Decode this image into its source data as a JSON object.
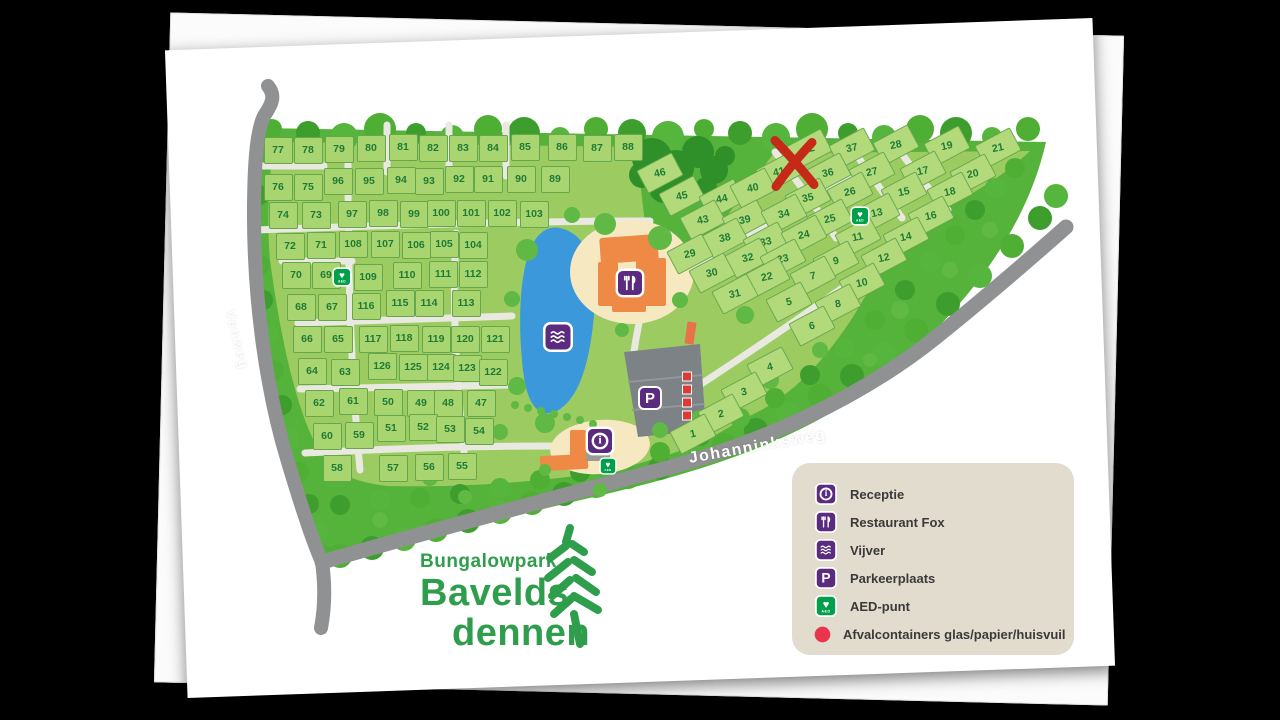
{
  "park_name": {
    "line1": "Bungalowpark",
    "line2": "Bavelds",
    "line3": "dennen"
  },
  "roads": {
    "venweg": {
      "text": "Venweg"
    },
    "johanninksweg": {
      "text": "Johanninksweg"
    }
  },
  "icons": {
    "receptie_glyph": "i",
    "parkeer_glyph": "P",
    "aed_text": "AED",
    "heart_glyph": "♥"
  },
  "legend": {
    "items": [
      {
        "icon": "receptie-icon",
        "label": "Receptie"
      },
      {
        "icon": "restaurant-icon",
        "label": "Restaurant Fox"
      },
      {
        "icon": "vijver-icon",
        "label": "Vijver"
      },
      {
        "icon": "parkeerplaats-icon",
        "label": "Parkeerplaats"
      },
      {
        "icon": "aed-icon",
        "label": "AED-punt"
      },
      {
        "icon": "afvalcontainer-icon",
        "label": "Afvalcontainers glas/papier/huisvuil"
      }
    ]
  },
  "colors": {
    "forest_green": "#55B23A",
    "interior_green": "#9CCB61",
    "plot_green": "#A9D571",
    "plot_number_green": "#1E7B36",
    "road_gray": "#8F9192",
    "path_white": "#E9E9E2",
    "pond_blue": "#3B99DB",
    "icon_purple": "#5B2B80",
    "aed_green": "#00A04B",
    "alert_red": "#DE3A34",
    "legend_bg": "#E2DCCF",
    "logo_green": "#2F9E4C",
    "building_orange": "#EE8A45",
    "sand_tan": "#F6E9C1"
  },
  "map": {
    "marker_x_note": "red X over plot 41",
    "plots": [
      {
        "n": "77",
        "x": 278,
        "y": 150,
        "s": "g"
      },
      {
        "n": "78",
        "x": 308,
        "y": 150,
        "s": "g"
      },
      {
        "n": "79",
        "x": 339,
        "y": 149,
        "s": "g"
      },
      {
        "n": "80",
        "x": 371,
        "y": 148,
        "s": "g"
      },
      {
        "n": "81",
        "x": 403,
        "y": 147,
        "s": "g"
      },
      {
        "n": "82",
        "x": 433,
        "y": 148,
        "s": "g"
      },
      {
        "n": "83",
        "x": 463,
        "y": 148,
        "s": "g"
      },
      {
        "n": "84",
        "x": 493,
        "y": 148,
        "s": "g"
      },
      {
        "n": "85",
        "x": 525,
        "y": 147,
        "s": "g"
      },
      {
        "n": "86",
        "x": 562,
        "y": 147,
        "s": "g"
      },
      {
        "n": "87",
        "x": 597,
        "y": 148,
        "s": "g"
      },
      {
        "n": "88",
        "x": 628,
        "y": 147,
        "s": "g"
      },
      {
        "n": "76",
        "x": 278,
        "y": 187,
        "s": "g"
      },
      {
        "n": "75",
        "x": 308,
        "y": 187,
        "s": "g"
      },
      {
        "n": "96",
        "x": 338,
        "y": 181,
        "s": "g"
      },
      {
        "n": "95",
        "x": 369,
        "y": 181,
        "s": "g"
      },
      {
        "n": "94",
        "x": 401,
        "y": 180,
        "s": "g"
      },
      {
        "n": "93",
        "x": 429,
        "y": 181,
        "s": "g"
      },
      {
        "n": "92",
        "x": 459,
        "y": 179,
        "s": "g"
      },
      {
        "n": "91",
        "x": 488,
        "y": 179,
        "s": "g"
      },
      {
        "n": "90",
        "x": 521,
        "y": 179,
        "s": "g"
      },
      {
        "n": "89",
        "x": 555,
        "y": 179,
        "s": "g"
      },
      {
        "n": "74",
        "x": 283,
        "y": 215,
        "s": "g"
      },
      {
        "n": "73",
        "x": 316,
        "y": 215,
        "s": "g"
      },
      {
        "n": "97",
        "x": 352,
        "y": 214,
        "s": "g"
      },
      {
        "n": "98",
        "x": 383,
        "y": 213,
        "s": "g"
      },
      {
        "n": "99",
        "x": 414,
        "y": 214,
        "s": "g"
      },
      {
        "n": "100",
        "x": 441,
        "y": 213,
        "s": "g"
      },
      {
        "n": "101",
        "x": 471,
        "y": 213,
        "s": "g"
      },
      {
        "n": "102",
        "x": 502,
        "y": 213,
        "s": "g"
      },
      {
        "n": "103",
        "x": 534,
        "y": 214,
        "s": "g"
      },
      {
        "n": "72",
        "x": 290,
        "y": 246,
        "s": "g"
      },
      {
        "n": "71",
        "x": 321,
        "y": 245,
        "s": "g"
      },
      {
        "n": "108",
        "x": 353,
        "y": 244,
        "s": "g"
      },
      {
        "n": "107",
        "x": 385,
        "y": 244,
        "s": "g"
      },
      {
        "n": "106",
        "x": 416,
        "y": 245,
        "s": "g"
      },
      {
        "n": "105",
        "x": 444,
        "y": 244,
        "s": "g"
      },
      {
        "n": "104",
        "x": 473,
        "y": 245,
        "s": "g"
      },
      {
        "n": "70",
        "x": 296,
        "y": 275,
        "s": "g"
      },
      {
        "n": "69",
        "x": 326,
        "y": 275,
        "s": "g"
      },
      {
        "n": "109",
        "x": 368,
        "y": 277,
        "s": "g"
      },
      {
        "n": "110",
        "x": 407,
        "y": 275,
        "s": "g"
      },
      {
        "n": "111",
        "x": 443,
        "y": 274,
        "s": "g"
      },
      {
        "n": "112",
        "x": 473,
        "y": 274,
        "s": "g"
      },
      {
        "n": "68",
        "x": 301,
        "y": 307,
        "s": "g"
      },
      {
        "n": "67",
        "x": 332,
        "y": 307,
        "s": "g"
      },
      {
        "n": "116",
        "x": 366,
        "y": 306,
        "s": "g"
      },
      {
        "n": "115",
        "x": 400,
        "y": 303,
        "s": "g"
      },
      {
        "n": "114",
        "x": 429,
        "y": 303,
        "s": "g"
      },
      {
        "n": "113",
        "x": 466,
        "y": 303,
        "s": "g"
      },
      {
        "n": "66",
        "x": 307,
        "y": 339,
        "s": "g"
      },
      {
        "n": "65",
        "x": 338,
        "y": 339,
        "s": "g"
      },
      {
        "n": "117",
        "x": 373,
        "y": 339,
        "s": "g"
      },
      {
        "n": "118",
        "x": 404,
        "y": 338,
        "s": "g"
      },
      {
        "n": "119",
        "x": 436,
        "y": 339,
        "s": "g"
      },
      {
        "n": "120",
        "x": 465,
        "y": 339,
        "s": "g"
      },
      {
        "n": "121",
        "x": 495,
        "y": 339,
        "s": "g"
      },
      {
        "n": "64",
        "x": 312,
        "y": 371,
        "s": "g"
      },
      {
        "n": "63",
        "x": 345,
        "y": 372,
        "s": "g"
      },
      {
        "n": "126",
        "x": 382,
        "y": 366,
        "s": "g"
      },
      {
        "n": "125",
        "x": 413,
        "y": 367,
        "s": "g"
      },
      {
        "n": "124",
        "x": 441,
        "y": 367,
        "s": "g"
      },
      {
        "n": "123",
        "x": 467,
        "y": 368,
        "s": "g"
      },
      {
        "n": "122",
        "x": 493,
        "y": 372,
        "s": "g"
      },
      {
        "n": "62",
        "x": 319,
        "y": 403,
        "s": "g"
      },
      {
        "n": "61",
        "x": 353,
        "y": 401,
        "s": "g"
      },
      {
        "n": "50",
        "x": 388,
        "y": 402,
        "s": "g"
      },
      {
        "n": "49",
        "x": 421,
        "y": 403,
        "s": "g"
      },
      {
        "n": "48",
        "x": 448,
        "y": 403,
        "s": "g"
      },
      {
        "n": "47",
        "x": 481,
        "y": 403,
        "s": "g"
      },
      {
        "n": "60",
        "x": 327,
        "y": 436,
        "s": "g"
      },
      {
        "n": "59",
        "x": 359,
        "y": 435,
        "s": "g"
      },
      {
        "n": "51",
        "x": 391,
        "y": 428,
        "s": "g"
      },
      {
        "n": "52",
        "x": 423,
        "y": 427,
        "s": "g"
      },
      {
        "n": "53",
        "x": 450,
        "y": 429,
        "s": "g"
      },
      {
        "n": "54",
        "x": 479,
        "y": 431,
        "s": "g"
      },
      {
        "n": "58",
        "x": 337,
        "y": 468,
        "s": "g"
      },
      {
        "n": "57",
        "x": 393,
        "y": 468,
        "s": "g"
      },
      {
        "n": "56",
        "x": 429,
        "y": 467,
        "s": "g"
      },
      {
        "n": "55",
        "x": 462,
        "y": 466,
        "s": "g"
      },
      {
        "n": "46",
        "x": 660,
        "y": 173,
        "s": "d"
      },
      {
        "n": "42",
        "x": 809,
        "y": 149,
        "s": "d"
      },
      {
        "n": "37",
        "x": 852,
        "y": 148,
        "s": "d"
      },
      {
        "n": "28",
        "x": 896,
        "y": 145,
        "s": "d"
      },
      {
        "n": "19",
        "x": 947,
        "y": 146,
        "s": "d"
      },
      {
        "n": "21",
        "x": 998,
        "y": 148,
        "s": "d"
      },
      {
        "n": "41",
        "x": 779,
        "y": 172,
        "s": "d"
      },
      {
        "n": "36",
        "x": 828,
        "y": 173,
        "s": "d"
      },
      {
        "n": "27",
        "x": 872,
        "y": 172,
        "s": "d"
      },
      {
        "n": "17",
        "x": 923,
        "y": 171,
        "s": "d"
      },
      {
        "n": "20",
        "x": 973,
        "y": 174,
        "s": "d"
      },
      {
        "n": "45",
        "x": 682,
        "y": 196,
        "s": "d"
      },
      {
        "n": "44",
        "x": 722,
        "y": 199,
        "s": "d"
      },
      {
        "n": "40",
        "x": 753,
        "y": 188,
        "s": "d"
      },
      {
        "n": "35",
        "x": 808,
        "y": 198,
        "s": "d"
      },
      {
        "n": "26",
        "x": 850,
        "y": 192,
        "s": "d"
      },
      {
        "n": "15",
        "x": 904,
        "y": 192,
        "s": "d"
      },
      {
        "n": "18",
        "x": 950,
        "y": 192,
        "s": "d"
      },
      {
        "n": "43",
        "x": 703,
        "y": 220,
        "s": "d"
      },
      {
        "n": "39",
        "x": 745,
        "y": 220,
        "s": "d"
      },
      {
        "n": "34",
        "x": 784,
        "y": 214,
        "s": "d"
      },
      {
        "n": "25",
        "x": 830,
        "y": 219,
        "s": "d"
      },
      {
        "n": "13",
        "x": 877,
        "y": 213,
        "s": "d"
      },
      {
        "n": "16",
        "x": 931,
        "y": 216,
        "s": "d"
      },
      {
        "n": "38",
        "x": 725,
        "y": 238,
        "s": "d"
      },
      {
        "n": "33",
        "x": 766,
        "y": 242,
        "s": "d"
      },
      {
        "n": "24",
        "x": 804,
        "y": 235,
        "s": "d"
      },
      {
        "n": "11",
        "x": 858,
        "y": 237,
        "s": "d"
      },
      {
        "n": "14",
        "x": 906,
        "y": 237,
        "s": "d"
      },
      {
        "n": "29",
        "x": 690,
        "y": 254,
        "s": "d"
      },
      {
        "n": "32",
        "x": 748,
        "y": 258,
        "s": "d"
      },
      {
        "n": "23",
        "x": 783,
        "y": 259,
        "s": "d"
      },
      {
        "n": "9",
        "x": 836,
        "y": 261,
        "s": "d"
      },
      {
        "n": "12",
        "x": 884,
        "y": 258,
        "s": "d"
      },
      {
        "n": "30",
        "x": 712,
        "y": 273,
        "s": "d"
      },
      {
        "n": "22",
        "x": 767,
        "y": 277,
        "s": "d"
      },
      {
        "n": "7",
        "x": 813,
        "y": 276,
        "s": "d"
      },
      {
        "n": "10",
        "x": 862,
        "y": 283,
        "s": "d"
      },
      {
        "n": "31",
        "x": 735,
        "y": 294,
        "s": "d"
      },
      {
        "n": "5",
        "x": 789,
        "y": 302,
        "s": "d"
      },
      {
        "n": "8",
        "x": 838,
        "y": 304,
        "s": "d"
      },
      {
        "n": "6",
        "x": 812,
        "y": 326,
        "s": "d"
      },
      {
        "n": "4",
        "x": 770,
        "y": 367,
        "s": "d"
      },
      {
        "n": "3",
        "x": 744,
        "y": 392,
        "s": "d"
      },
      {
        "n": "2",
        "x": 721,
        "y": 414,
        "s": "d"
      },
      {
        "n": "1",
        "x": 693,
        "y": 434,
        "s": "d"
      }
    ],
    "pois": [
      {
        "type": "receptie",
        "x": 600,
        "y": 441,
        "scale": 1.2
      },
      {
        "type": "restaurant",
        "x": 630,
        "y": 283,
        "scale": 1.2
      },
      {
        "type": "vijver",
        "x": 558,
        "y": 337,
        "scale": 1.25
      },
      {
        "type": "parkeer",
        "x": 650,
        "y": 398,
        "scale": 1.0
      },
      {
        "type": "aed",
        "x": 342,
        "y": 277,
        "scale": 0.8
      },
      {
        "type": "aed",
        "x": 860,
        "y": 216,
        "scale": 0.8
      },
      {
        "type": "aed",
        "x": 608,
        "y": 466,
        "scale": 0.72
      },
      {
        "type": "afvalstrip",
        "x": 687,
        "y": 396,
        "scale": 1.0
      },
      {
        "type": "redx",
        "x": 795,
        "y": 166,
        "scale": 1.0
      }
    ]
  }
}
